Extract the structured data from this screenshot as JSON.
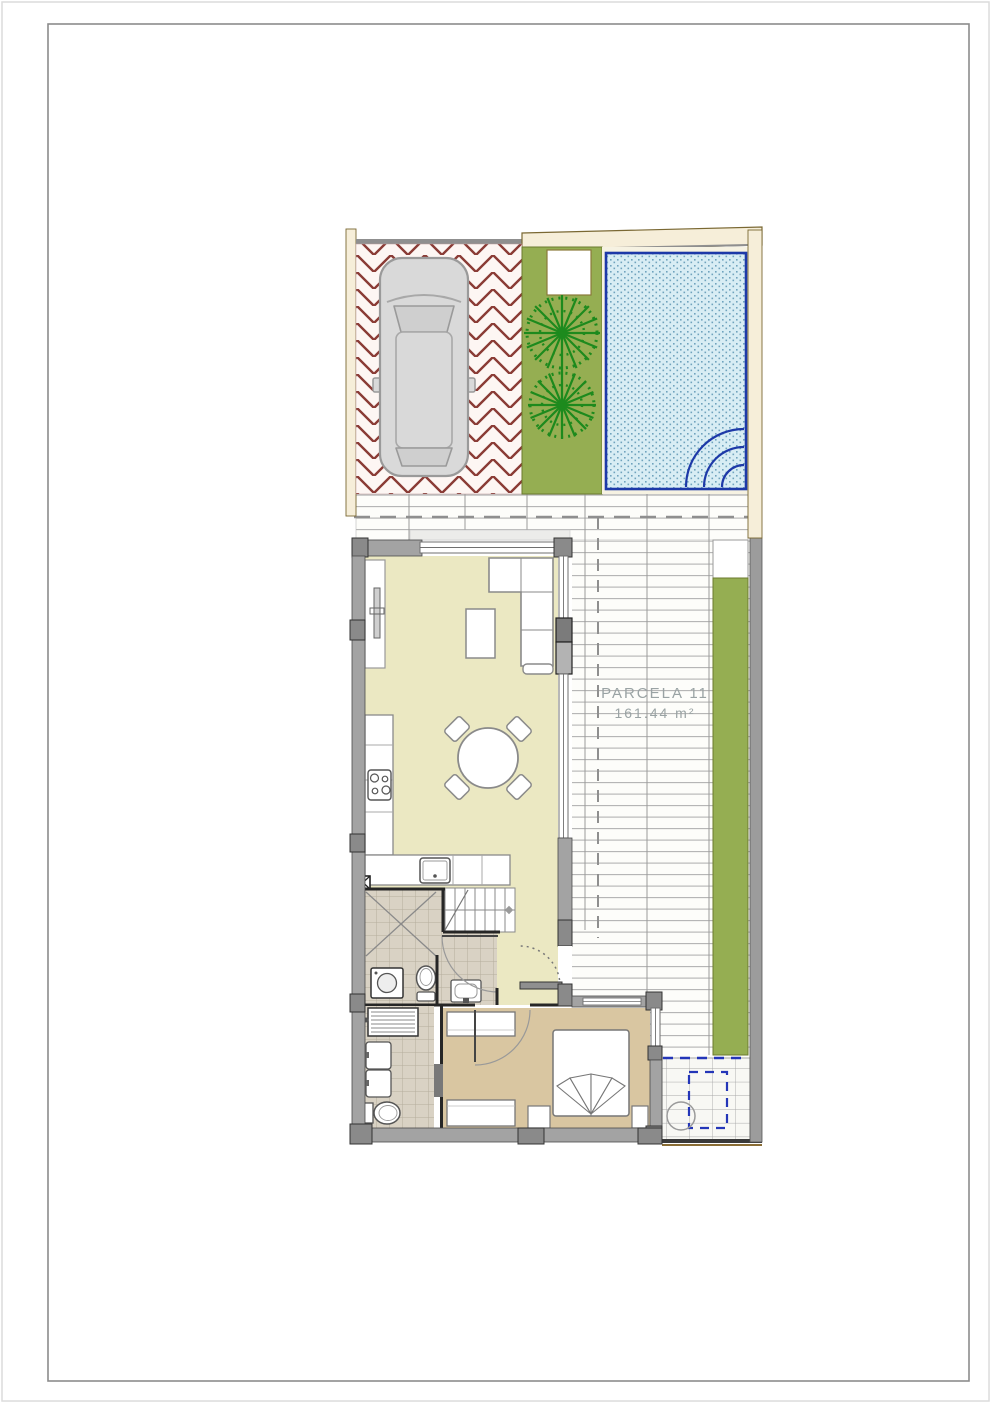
{
  "document": {
    "type": "floor-plan-sheet",
    "background": "#ffffff",
    "outer_border_color": "#dcdcdc",
    "frame_color": "#8c8c8c"
  },
  "parcel": {
    "label": "PARCELA 11",
    "area": "161.44 m²",
    "label_color": "#9aa3a4"
  },
  "palette": {
    "paving_line": "#8a3b35",
    "paving_bg": "#fdf6f3",
    "grass_green": "#95ae52",
    "tree_green": "#1d8a1d",
    "pool_border": "#1d39a8",
    "pool_water": "#d8edf4",
    "pool_dot": "#6fa3bd",
    "deck_bg": "#fdfdfa",
    "deck_line": "#b3b3b3",
    "wall_gray": "#a3a3a3",
    "pillar_gray": "#8a8a8a",
    "partition_dark": "#262626",
    "floor_living": "#ebe8c2",
    "floor_bedroom": "#d9c6a1",
    "bathroom_tile": "#d9d2c4",
    "tile_line": "#b5ad9d",
    "boundary_cream": "#f6eed9",
    "boundary_brown": "#7a6833",
    "annotation_blue": "#2436b8",
    "car_body": "#d9d9d9",
    "furniture_line": "#8a8a8a"
  },
  "icons": {
    "car": "car-top-view",
    "tree": "round-tree-symbol",
    "pool_steps": "quarter-circle-steps",
    "shower": "x-cross-shower",
    "stairs": "treads-with-break-line"
  }
}
